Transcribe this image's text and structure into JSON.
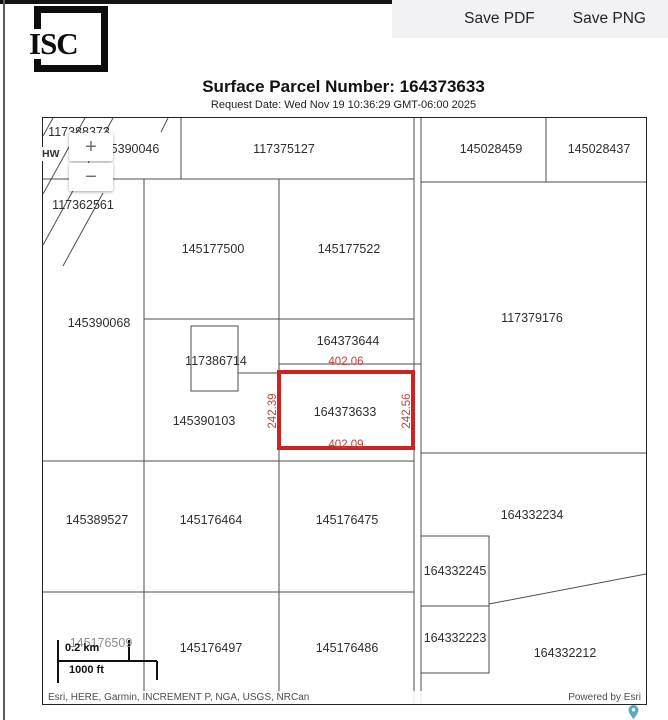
{
  "header": {
    "logo_text": "ISC",
    "save_pdf_label": "Save PDF",
    "save_png_label": "Save PNG"
  },
  "title": "Surface Parcel Number: 164373633",
  "request_date": "Request Date: Wed Nov 19 10:36:29 GMT-06:00 2025",
  "map": {
    "zoom_in_label": "+",
    "zoom_out_label": "−",
    "highway_label": "HW",
    "colors": {
      "highlight": "#cc2222",
      "measurement": "#c14438",
      "pin": "#55abc9"
    },
    "highlighted_parcel": "164373633",
    "labels": [
      {
        "text": "117388373",
        "x": 36,
        "y": 14
      },
      {
        "text": "5390046",
        "x": 92,
        "y": 31
      },
      {
        "text": "117362561",
        "x": 40,
        "y": 87
      },
      {
        "text": "117375127",
        "x": 241,
        "y": 31
      },
      {
        "text": "145028459",
        "x": 448,
        "y": 31
      },
      {
        "text": "145028437",
        "x": 556,
        "y": 31
      },
      {
        "text": "145177500",
        "x": 170,
        "y": 131
      },
      {
        "text": "145177522",
        "x": 306,
        "y": 131
      },
      {
        "text": "117379176",
        "x": 489,
        "y": 200
      },
      {
        "text": "145390068",
        "x": 56,
        "y": 205
      },
      {
        "text": "164373644",
        "x": 305,
        "y": 223
      },
      {
        "text": "117386714",
        "x": 173,
        "y": 243
      },
      {
        "text": "402.06",
        "x": 303,
        "y": 244,
        "cls": "red",
        "name": "measurement-top"
      },
      {
        "text": "242.39",
        "x": 230,
        "y": 293,
        "cls": "red vert",
        "name": "measurement-left"
      },
      {
        "text": "164373633",
        "x": 302,
        "y": 294,
        "name": "highlighted-parcel-label"
      },
      {
        "text": "242.56",
        "x": 364,
        "y": 293,
        "cls": "red vert",
        "name": "measurement-right"
      },
      {
        "text": "402.09",
        "x": 303,
        "y": 327,
        "cls": "red",
        "name": "measurement-bottom"
      },
      {
        "text": "145390103",
        "x": 161,
        "y": 303
      },
      {
        "text": "145389527",
        "x": 54,
        "y": 402
      },
      {
        "text": "145176464",
        "x": 168,
        "y": 402
      },
      {
        "text": "145176475",
        "x": 304,
        "y": 402
      },
      {
        "text": "164332234",
        "x": 489,
        "y": 397
      },
      {
        "text": "164332245",
        "x": 412,
        "y": 453
      },
      {
        "text": "164332223",
        "x": 412,
        "y": 520
      },
      {
        "text": "164332212",
        "x": 522,
        "y": 535
      },
      {
        "text": "145176509",
        "x": 58,
        "y": 525,
        "cls": "gray"
      },
      {
        "text": "145176497",
        "x": 168,
        "y": 530
      },
      {
        "text": "145176486",
        "x": 304,
        "y": 530
      }
    ],
    "scale": {
      "km": "0.2 km",
      "ft": "1000 ft"
    },
    "attribution": "Esri, HERE, Garmin, INCREMENT P, NGA, USGS, NRCan",
    "powered_by": "Powered by Esri"
  }
}
